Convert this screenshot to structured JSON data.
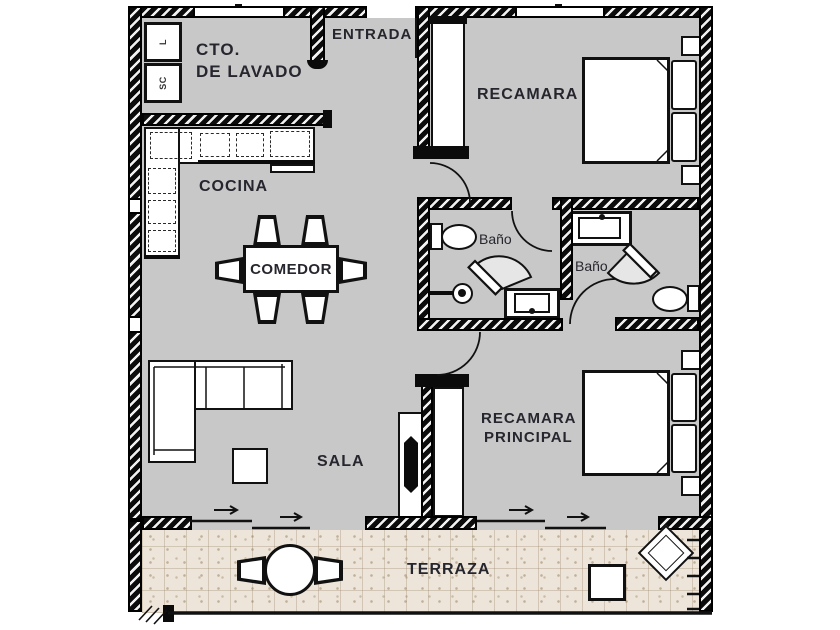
{
  "plan": {
    "title": "apartment floor plan",
    "colors": {
      "floor": "#c8c8c8",
      "terrace": "#EDE5DA",
      "wall": "#0b0b0b",
      "text": "#26262e"
    },
    "rooms": {
      "laundry": {
        "label_line1": "CTO.",
        "label_line2": "DE LAVADO"
      },
      "entry": {
        "label": "ENTRADA"
      },
      "bedroom": {
        "label": "RECAMARA"
      },
      "kitchen": {
        "label": "COCINA"
      },
      "dining": {
        "label": "COMEDOR"
      },
      "bath1": {
        "label": "Baño"
      },
      "bath2": {
        "label": "Baño"
      },
      "living": {
        "label": "SALA"
      },
      "master": {
        "label_line1": "RECAMARA",
        "label_line2": "PRINCIPAL"
      },
      "terrace": {
        "label": "TERRAZA"
      }
    },
    "appliances": {
      "washer": "L",
      "dryer": "SC"
    }
  }
}
